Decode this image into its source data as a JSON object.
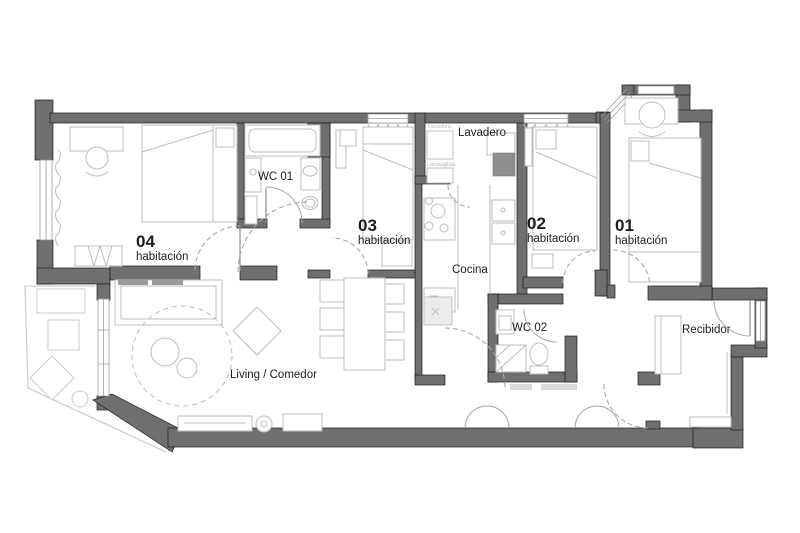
{
  "colors": {
    "wall": "#6f6f6f",
    "wall_stroke": "#1c1c1c",
    "furn": "#bdbdbd",
    "furn_dark": "#9a9a9a",
    "balcony": "#cfcfcf",
    "arc": "#a8a8a8",
    "text": "#1c1c1c",
    "text_light": "#b5b5b5",
    "bg": "#ffffff"
  },
  "rooms": {
    "room04": {
      "number": "04",
      "type": "habitación"
    },
    "room03": {
      "number": "03",
      "type": "habitación"
    },
    "room02": {
      "number": "02",
      "type": "habitación"
    },
    "room01": {
      "number": "01",
      "type": "habitación"
    },
    "wc01": {
      "label": "WC 01"
    },
    "wc02": {
      "label": "WC 02"
    },
    "lavadero": {
      "label": "Lavadero",
      "appliances": {
        "washer": "Lavadora",
        "dishwasher": "Lavavajillas"
      }
    },
    "cocina": {
      "label": "Cocina"
    },
    "living": {
      "label": "Living / Comedor"
    },
    "recibidor": {
      "label": "Recibidor"
    }
  }
}
